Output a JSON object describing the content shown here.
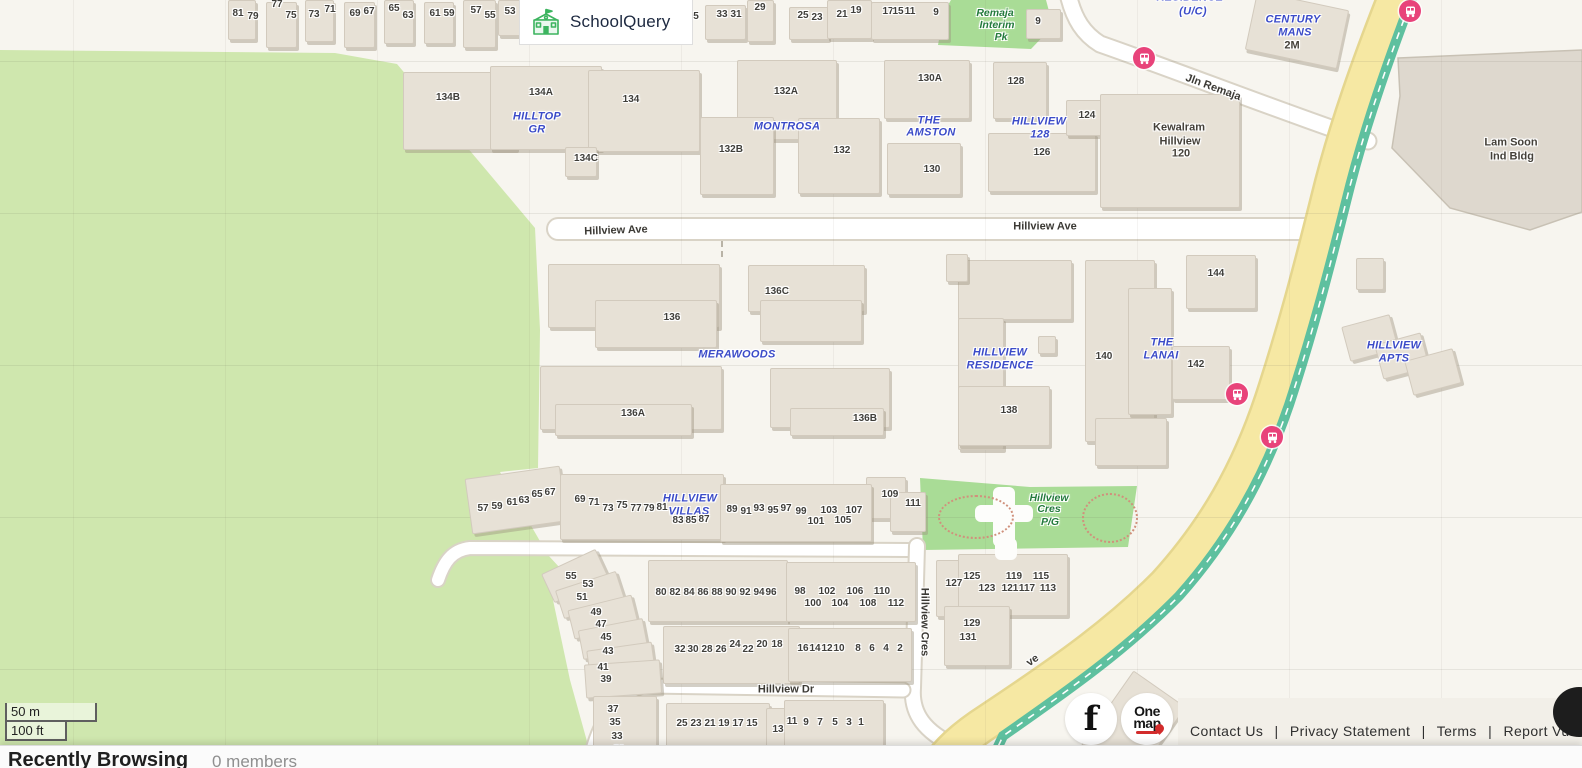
{
  "brand": {
    "name": "SchoolQuery"
  },
  "scale_bar": {
    "metric": "50 m",
    "imperial": "100 ft"
  },
  "bottom_bar": {
    "title": "Recently Browsing",
    "members": "0 members"
  },
  "footer": {
    "links": [
      "Contact Us",
      "Privacy Statement",
      "Terms",
      "Report Vulne"
    ],
    "separator": "|",
    "facebook": "f",
    "onemap": {
      "line1": "One",
      "line2": "map"
    }
  },
  "map": {
    "colors": {
      "background": "#f7f5ef",
      "forest": "#cfe7ae",
      "park": "#a9dc96",
      "building": "#e7e1d6",
      "road_white": "#ffffff",
      "road_yellow": "#f6e8a3",
      "path_teal": "#5ec09f",
      "bus_stop": "#e8437a",
      "estate_label": "#3b4bc8",
      "area_label": "#237a3c"
    },
    "labels": [
      {
        "t": "num",
        "s": "81",
        "x": 238,
        "y": 14
      },
      {
        "t": "num",
        "s": "79",
        "x": 253,
        "y": 17
      },
      {
        "t": "num",
        "s": "77",
        "x": 277,
        "y": 5
      },
      {
        "t": "num",
        "s": "75",
        "x": 291,
        "y": 16
      },
      {
        "t": "num",
        "s": "73",
        "x": 314,
        "y": 15
      },
      {
        "t": "num",
        "s": "71",
        "x": 330,
        "y": 10
      },
      {
        "t": "num",
        "s": "69",
        "x": 355,
        "y": 14
      },
      {
        "t": "num",
        "s": "67",
        "x": 369,
        "y": 12
      },
      {
        "t": "num",
        "s": "65",
        "x": 394,
        "y": 9
      },
      {
        "t": "num",
        "s": "63",
        "x": 408,
        "y": 16
      },
      {
        "t": "num",
        "s": "61",
        "x": 435,
        "y": 14
      },
      {
        "t": "num",
        "s": "59",
        "x": 449,
        "y": 14
      },
      {
        "t": "num",
        "s": "57",
        "x": 476,
        "y": 11
      },
      {
        "t": "num",
        "s": "55",
        "x": 490,
        "y": 16
      },
      {
        "t": "num",
        "s": "53",
        "x": 510,
        "y": 12
      },
      {
        "t": "num",
        "s": "5",
        "x": 696,
        "y": 17
      },
      {
        "t": "num",
        "s": "33",
        "x": 722,
        "y": 15
      },
      {
        "t": "num",
        "s": "31",
        "x": 736,
        "y": 15
      },
      {
        "t": "num",
        "s": "29",
        "x": 760,
        "y": 8
      },
      {
        "t": "num",
        "s": "25",
        "x": 803,
        "y": 16
      },
      {
        "t": "num",
        "s": "23",
        "x": 817,
        "y": 18
      },
      {
        "t": "num",
        "s": "21",
        "x": 842,
        "y": 15
      },
      {
        "t": "num",
        "s": "19",
        "x": 856,
        "y": 11
      },
      {
        "t": "num",
        "s": "17",
        "x": 888,
        "y": 12
      },
      {
        "t": "num",
        "s": "15",
        "x": 898,
        "y": 12
      },
      {
        "t": "num",
        "s": "11",
        "x": 910,
        "y": 12
      },
      {
        "t": "num",
        "s": "9",
        "x": 936,
        "y": 13
      },
      {
        "t": "num",
        "s": "9",
        "x": 1038,
        "y": 22
      },
      {
        "t": "area",
        "s": "Remaja",
        "x": 995,
        "y": 13
      },
      {
        "t": "area",
        "s": "Interim",
        "x": 997,
        "y": 25
      },
      {
        "t": "area",
        "s": "Pk",
        "x": 1001,
        "y": 37
      },
      {
        "t": "est",
        "s": "RESIDENCE",
        "x": 1190,
        "y": -2
      },
      {
        "t": "est",
        "s": "(U/C)",
        "x": 1193,
        "y": 12
      },
      {
        "t": "est",
        "s": "CENTURY",
        "x": 1293,
        "y": 20
      },
      {
        "t": "est",
        "s": "MANS",
        "x": 1295,
        "y": 33
      },
      {
        "t": "name",
        "s": "2M",
        "x": 1292,
        "y": 46
      },
      {
        "t": "road",
        "s": "Jln Remaja",
        "x": 1213,
        "y": 88,
        "r": 20
      },
      {
        "t": "num",
        "s": "134B",
        "x": 448,
        "y": 98
      },
      {
        "t": "num",
        "s": "134A",
        "x": 541,
        "y": 93
      },
      {
        "t": "num",
        "s": "134",
        "x": 631,
        "y": 100
      },
      {
        "t": "num",
        "s": "134C",
        "x": 586,
        "y": 159
      },
      {
        "t": "est",
        "s": "HILLTOP",
        "x": 537,
        "y": 117
      },
      {
        "t": "est",
        "s": "GR",
        "x": 537,
        "y": 130
      },
      {
        "t": "num",
        "s": "132A",
        "x": 786,
        "y": 92
      },
      {
        "t": "est",
        "s": "MONTROSA",
        "x": 787,
        "y": 127
      },
      {
        "t": "num",
        "s": "132B",
        "x": 731,
        "y": 150
      },
      {
        "t": "num",
        "s": "132",
        "x": 842,
        "y": 151
      },
      {
        "t": "num",
        "s": "130A",
        "x": 930,
        "y": 79
      },
      {
        "t": "est",
        "s": "THE",
        "x": 929,
        "y": 121
      },
      {
        "t": "est",
        "s": "AMSTON",
        "x": 931,
        "y": 133
      },
      {
        "t": "num",
        "s": "130",
        "x": 932,
        "y": 170
      },
      {
        "t": "num",
        "s": "128",
        "x": 1016,
        "y": 82
      },
      {
        "t": "est",
        "s": "HILLVIEW",
        "x": 1039,
        "y": 122
      },
      {
        "t": "est",
        "s": "128",
        "x": 1040,
        "y": 135
      },
      {
        "t": "num",
        "s": "126",
        "x": 1042,
        "y": 153
      },
      {
        "t": "num",
        "s": "124",
        "x": 1087,
        "y": 116
      },
      {
        "t": "name",
        "s": "Kewalram",
        "x": 1179,
        "y": 128
      },
      {
        "t": "name",
        "s": "Hillview",
        "x": 1180,
        "y": 142
      },
      {
        "t": "name",
        "s": "120",
        "x": 1181,
        "y": 154
      },
      {
        "t": "name",
        "s": "Lam Soon",
        "x": 1511,
        "y": 143
      },
      {
        "t": "name",
        "s": "Ind Bldg",
        "x": 1512,
        "y": 157
      },
      {
        "t": "road",
        "s": "Hillview Ave",
        "x": 616,
        "y": 231,
        "r": -2
      },
      {
        "t": "road",
        "s": "Hillview Ave",
        "x": 1045,
        "y": 227
      },
      {
        "t": "num",
        "s": "136C",
        "x": 777,
        "y": 292
      },
      {
        "t": "num",
        "s": "136",
        "x": 672,
        "y": 318
      },
      {
        "t": "est",
        "s": "MERAWOODS",
        "x": 737,
        "y": 355
      },
      {
        "t": "num",
        "s": "136A",
        "x": 633,
        "y": 414
      },
      {
        "t": "num",
        "s": "136B",
        "x": 865,
        "y": 419
      },
      {
        "t": "est",
        "s": "HILLVIEW",
        "x": 1000,
        "y": 353
      },
      {
        "t": "est",
        "s": "RESIDENCE",
        "x": 1000,
        "y": 366
      },
      {
        "t": "num",
        "s": "138",
        "x": 1009,
        "y": 411
      },
      {
        "t": "num",
        "s": "140",
        "x": 1104,
        "y": 357
      },
      {
        "t": "est",
        "s": "THE",
        "x": 1162,
        "y": 343
      },
      {
        "t": "est",
        "s": "LANAI",
        "x": 1161,
        "y": 356
      },
      {
        "t": "num",
        "s": "142",
        "x": 1196,
        "y": 365
      },
      {
        "t": "num",
        "s": "144",
        "x": 1216,
        "y": 274
      },
      {
        "t": "est",
        "s": "HILLVIEW",
        "x": 1394,
        "y": 346
      },
      {
        "t": "est",
        "s": "APTS",
        "x": 1394,
        "y": 359
      },
      {
        "t": "num",
        "s": "57",
        "x": 483,
        "y": 509
      },
      {
        "t": "num",
        "s": "59",
        "x": 497,
        "y": 507
      },
      {
        "t": "num",
        "s": "61",
        "x": 512,
        "y": 503
      },
      {
        "t": "num",
        "s": "63",
        "x": 524,
        "y": 501
      },
      {
        "t": "num",
        "s": "65",
        "x": 537,
        "y": 495
      },
      {
        "t": "num",
        "s": "67",
        "x": 550,
        "y": 493
      },
      {
        "t": "num",
        "s": "69",
        "x": 580,
        "y": 500
      },
      {
        "t": "num",
        "s": "71",
        "x": 594,
        "y": 503
      },
      {
        "t": "num",
        "s": "73",
        "x": 608,
        "y": 509
      },
      {
        "t": "num",
        "s": "75",
        "x": 622,
        "y": 506
      },
      {
        "t": "num",
        "s": "77",
        "x": 636,
        "y": 509
      },
      {
        "t": "num",
        "s": "79",
        "x": 649,
        "y": 509
      },
      {
        "t": "num",
        "s": "81",
        "x": 662,
        "y": 508
      },
      {
        "t": "est",
        "s": "HILLVIEW",
        "x": 690,
        "y": 499
      },
      {
        "t": "est",
        "s": "VILLAS",
        "x": 689,
        "y": 512
      },
      {
        "t": "num",
        "s": "83",
        "x": 678,
        "y": 521
      },
      {
        "t": "num",
        "s": "85",
        "x": 691,
        "y": 521
      },
      {
        "t": "num",
        "s": "87",
        "x": 704,
        "y": 520
      },
      {
        "t": "num",
        "s": "89",
        "x": 732,
        "y": 510
      },
      {
        "t": "num",
        "s": "91",
        "x": 746,
        "y": 512
      },
      {
        "t": "num",
        "s": "93",
        "x": 759,
        "y": 509
      },
      {
        "t": "num",
        "s": "95",
        "x": 773,
        "y": 511
      },
      {
        "t": "num",
        "s": "97",
        "x": 786,
        "y": 509
      },
      {
        "t": "num",
        "s": "99",
        "x": 801,
        "y": 512
      },
      {
        "t": "num",
        "s": "101",
        "x": 816,
        "y": 522
      },
      {
        "t": "num",
        "s": "103",
        "x": 829,
        "y": 511
      },
      {
        "t": "num",
        "s": "105",
        "x": 843,
        "y": 521
      },
      {
        "t": "num",
        "s": "107",
        "x": 854,
        "y": 511
      },
      {
        "t": "num",
        "s": "109",
        "x": 890,
        "y": 495
      },
      {
        "t": "num",
        "s": "111",
        "x": 913,
        "y": 504
      },
      {
        "t": "area",
        "s": "Hillview",
        "x": 1049,
        "y": 498
      },
      {
        "t": "area",
        "s": "Cres",
        "x": 1049,
        "y": 509
      },
      {
        "t": "area",
        "s": "P/G",
        "x": 1050,
        "y": 522
      },
      {
        "t": "num",
        "s": "80",
        "x": 661,
        "y": 593
      },
      {
        "t": "num",
        "s": "82",
        "x": 675,
        "y": 593
      },
      {
        "t": "num",
        "s": "84",
        "x": 689,
        "y": 593
      },
      {
        "t": "num",
        "s": "86",
        "x": 703,
        "y": 593
      },
      {
        "t": "num",
        "s": "88",
        "x": 717,
        "y": 593
      },
      {
        "t": "num",
        "s": "90",
        "x": 731,
        "y": 593
      },
      {
        "t": "num",
        "s": "92",
        "x": 745,
        "y": 593
      },
      {
        "t": "num",
        "s": "94",
        "x": 759,
        "y": 593
      },
      {
        "t": "num",
        "s": "96",
        "x": 771,
        "y": 593
      },
      {
        "t": "num",
        "s": "98",
        "x": 800,
        "y": 592
      },
      {
        "t": "num",
        "s": "100",
        "x": 813,
        "y": 604
      },
      {
        "t": "num",
        "s": "102",
        "x": 827,
        "y": 592
      },
      {
        "t": "num",
        "s": "104",
        "x": 840,
        "y": 604
      },
      {
        "t": "num",
        "s": "106",
        "x": 855,
        "y": 592
      },
      {
        "t": "num",
        "s": "108",
        "x": 868,
        "y": 604
      },
      {
        "t": "num",
        "s": "110",
        "x": 882,
        "y": 592
      },
      {
        "t": "num",
        "s": "112",
        "x": 896,
        "y": 604
      },
      {
        "t": "num",
        "s": "127",
        "x": 954,
        "y": 584
      },
      {
        "t": "num",
        "s": "125",
        "x": 972,
        "y": 577
      },
      {
        "t": "num",
        "s": "123",
        "x": 987,
        "y": 589
      },
      {
        "t": "num",
        "s": "119",
        "x": 1014,
        "y": 577
      },
      {
        "t": "num",
        "s": "121",
        "x": 1010,
        "y": 589
      },
      {
        "t": "num",
        "s": "117",
        "x": 1027,
        "y": 589
      },
      {
        "t": "num",
        "s": "115",
        "x": 1041,
        "y": 577
      },
      {
        "t": "num",
        "s": "113",
        "x": 1048,
        "y": 589
      },
      {
        "t": "num",
        "s": "129",
        "x": 972,
        "y": 624
      },
      {
        "t": "num",
        "s": "131",
        "x": 968,
        "y": 638
      },
      {
        "t": "num",
        "s": "32",
        "x": 680,
        "y": 650
      },
      {
        "t": "num",
        "s": "30",
        "x": 693,
        "y": 650
      },
      {
        "t": "num",
        "s": "28",
        "x": 707,
        "y": 650
      },
      {
        "t": "num",
        "s": "26",
        "x": 721,
        "y": 650
      },
      {
        "t": "num",
        "s": "24",
        "x": 735,
        "y": 645
      },
      {
        "t": "num",
        "s": "22",
        "x": 748,
        "y": 650
      },
      {
        "t": "num",
        "s": "20",
        "x": 762,
        "y": 645
      },
      {
        "t": "num",
        "s": "18",
        "x": 777,
        "y": 645
      },
      {
        "t": "num",
        "s": "16",
        "x": 803,
        "y": 649
      },
      {
        "t": "num",
        "s": "14",
        "x": 815,
        "y": 649
      },
      {
        "t": "num",
        "s": "12",
        "x": 827,
        "y": 649
      },
      {
        "t": "num",
        "s": "10",
        "x": 839,
        "y": 649
      },
      {
        "t": "num",
        "s": "8",
        "x": 858,
        "y": 649
      },
      {
        "t": "num",
        "s": "6",
        "x": 872,
        "y": 649
      },
      {
        "t": "num",
        "s": "4",
        "x": 886,
        "y": 649
      },
      {
        "t": "num",
        "s": "2",
        "x": 900,
        "y": 649
      },
      {
        "t": "road",
        "s": "Hillview Cres",
        "x": 924,
        "y": 622,
        "r": 90
      },
      {
        "t": "road",
        "s": "Hillview Dr",
        "x": 786,
        "y": 690
      },
      {
        "t": "road",
        "s": "ve",
        "x": 1033,
        "y": 661,
        "r": -35
      },
      {
        "t": "num",
        "s": "55",
        "x": 571,
        "y": 577
      },
      {
        "t": "num",
        "s": "53",
        "x": 588,
        "y": 585
      },
      {
        "t": "num",
        "s": "51",
        "x": 582,
        "y": 598
      },
      {
        "t": "num",
        "s": "49",
        "x": 596,
        "y": 613
      },
      {
        "t": "num",
        "s": "47",
        "x": 601,
        "y": 625
      },
      {
        "t": "num",
        "s": "45",
        "x": 606,
        "y": 638
      },
      {
        "t": "num",
        "s": "43",
        "x": 608,
        "y": 652
      },
      {
        "t": "num",
        "s": "41",
        "x": 603,
        "y": 668
      },
      {
        "t": "num",
        "s": "39",
        "x": 606,
        "y": 680
      },
      {
        "t": "num",
        "s": "37",
        "x": 613,
        "y": 710
      },
      {
        "t": "num",
        "s": "35",
        "x": 615,
        "y": 723
      },
      {
        "t": "num",
        "s": "33",
        "x": 617,
        "y": 737
      },
      {
        "t": "num",
        "s": "31",
        "x": 619,
        "y": 750
      },
      {
        "t": "num",
        "s": "25",
        "x": 682,
        "y": 724
      },
      {
        "t": "num",
        "s": "23",
        "x": 696,
        "y": 724
      },
      {
        "t": "num",
        "s": "21",
        "x": 710,
        "y": 724
      },
      {
        "t": "num",
        "s": "19",
        "x": 724,
        "y": 724
      },
      {
        "t": "num",
        "s": "17",
        "x": 738,
        "y": 724
      },
      {
        "t": "num",
        "s": "15",
        "x": 752,
        "y": 724
      },
      {
        "t": "num",
        "s": "13",
        "x": 778,
        "y": 730
      },
      {
        "t": "num",
        "s": "11",
        "x": 792,
        "y": 722
      },
      {
        "t": "num",
        "s": "9",
        "x": 806,
        "y": 723
      },
      {
        "t": "num",
        "s": "7",
        "x": 820,
        "y": 723
      },
      {
        "t": "num",
        "s": "5",
        "x": 835,
        "y": 723
      },
      {
        "t": "num",
        "s": "3",
        "x": 849,
        "y": 723
      },
      {
        "t": "num",
        "s": "1",
        "x": 861,
        "y": 723
      }
    ]
  }
}
